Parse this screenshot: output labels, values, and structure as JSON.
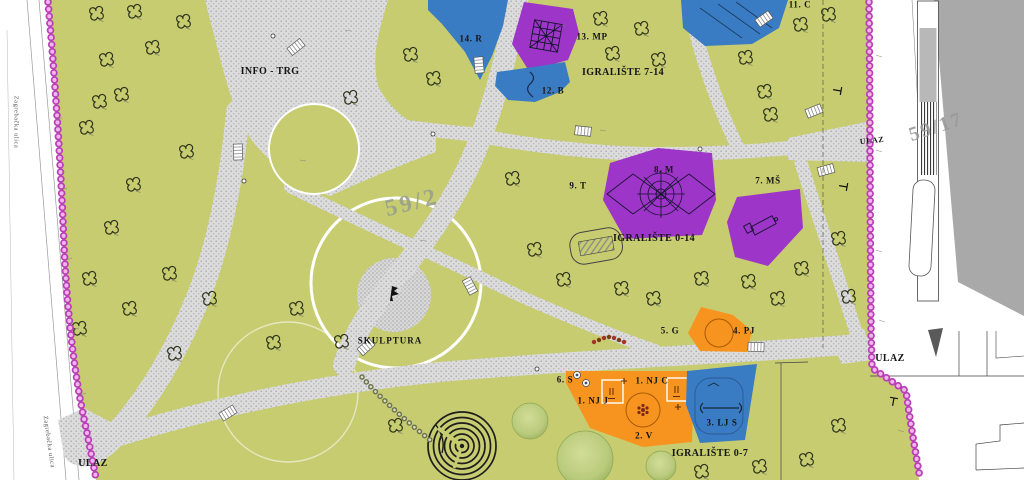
{
  "palette": {
    "park_green": "#c6cc6f",
    "path_fill": "#dcdcdc",
    "zone_blue": "#3a7cc3",
    "zone_purple": "#9c35c8",
    "zone_orange": "#f79420",
    "boundary_pink_dark": "#b93fb6",
    "boundary_pink_light": "#f2b5ee",
    "tree_fill": "#b9cb7c",
    "building_gray": "#a9a9a9",
    "parcel_text": "#9aa08b",
    "street_text": "#555555",
    "label_black": "#151515"
  },
  "labels": {
    "info_trg": {
      "text": "INFO - TRG"
    },
    "item_14": {
      "text": "14. R"
    },
    "item_13": {
      "text": "13. MP"
    },
    "igraliste_7_14": {
      "text": "IGRALIŠTE 7-14"
    },
    "item_12": {
      "text": "12. B"
    },
    "item_11": {
      "text": "11. C"
    },
    "item_9": {
      "text": "9. T"
    },
    "item_8": {
      "text": "8. M"
    },
    "item_7": {
      "text": "7. MŠ"
    },
    "igraliste_0_14": {
      "text": "IGRALIŠTE 0-14"
    },
    "parcel_59_2": {
      "text": "59/2"
    },
    "skulptura": {
      "text": "SKULPTURA"
    },
    "item_5": {
      "text": "5. G"
    },
    "item_4": {
      "text": "4. PJ"
    },
    "item_6": {
      "text": "6. S"
    },
    "item_1c": {
      "text": "1. NJ C"
    },
    "item_1j": {
      "text": "1. NJ J"
    },
    "item_2": {
      "text": "2. V"
    },
    "item_3": {
      "text": "3. LJ S"
    },
    "igraliste_0_7": {
      "text": "IGRALIŠTE 0-7"
    },
    "ulaz_top_right": {
      "text": "ULAZ"
    },
    "ulaz_bottom_right": {
      "text": "ULAZ"
    },
    "ulaz_bottom_left": {
      "text": "ULAZ"
    },
    "parcel_59_17": {
      "text": "59/17"
    },
    "street_upper": {
      "text": "Zagrebačka ulica"
    },
    "street_lower": {
      "text": "Zagrebačka ulica"
    }
  }
}
